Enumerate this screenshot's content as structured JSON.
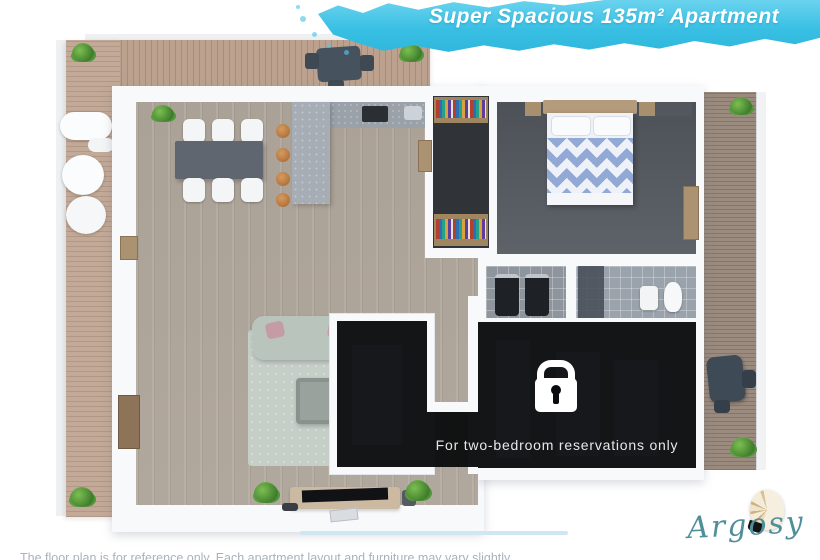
{
  "banner": {
    "title": "Super Spacious 135m² Apartment",
    "bg_color": "#35bde2",
    "text_color": "#ffffff"
  },
  "locked_section": {
    "icon": "lock-icon",
    "caption": "For two-bedroom reservations only",
    "bg_color": "#0a0b0d",
    "text_color": "#e8e8e8"
  },
  "branding": {
    "logo_text": "Argosy",
    "logo_color": "#4f8f9a",
    "shell_icon": "nautilus-shell-icon"
  },
  "footer": {
    "disclaimer": "The floor plan is for reference only. Each apartment layout and furniture may vary slightly",
    "text_color": "#a9b2bd"
  },
  "floor_plan": {
    "wall_color": "#f8f9fb",
    "interior_floor_color": "#b2a99e",
    "bedroom_floor_color": "#585d64",
    "deck_wood_color": "#bca28e",
    "balcony_wood_color": "#9a8b7e",
    "rug_color": "#c6cec8",
    "sofa_color": "#b9c4bd",
    "bed_blanket_color": "#92a9d6",
    "kitchen_island_color": "#a7adb5",
    "bar_stool_color": "#c08449"
  }
}
